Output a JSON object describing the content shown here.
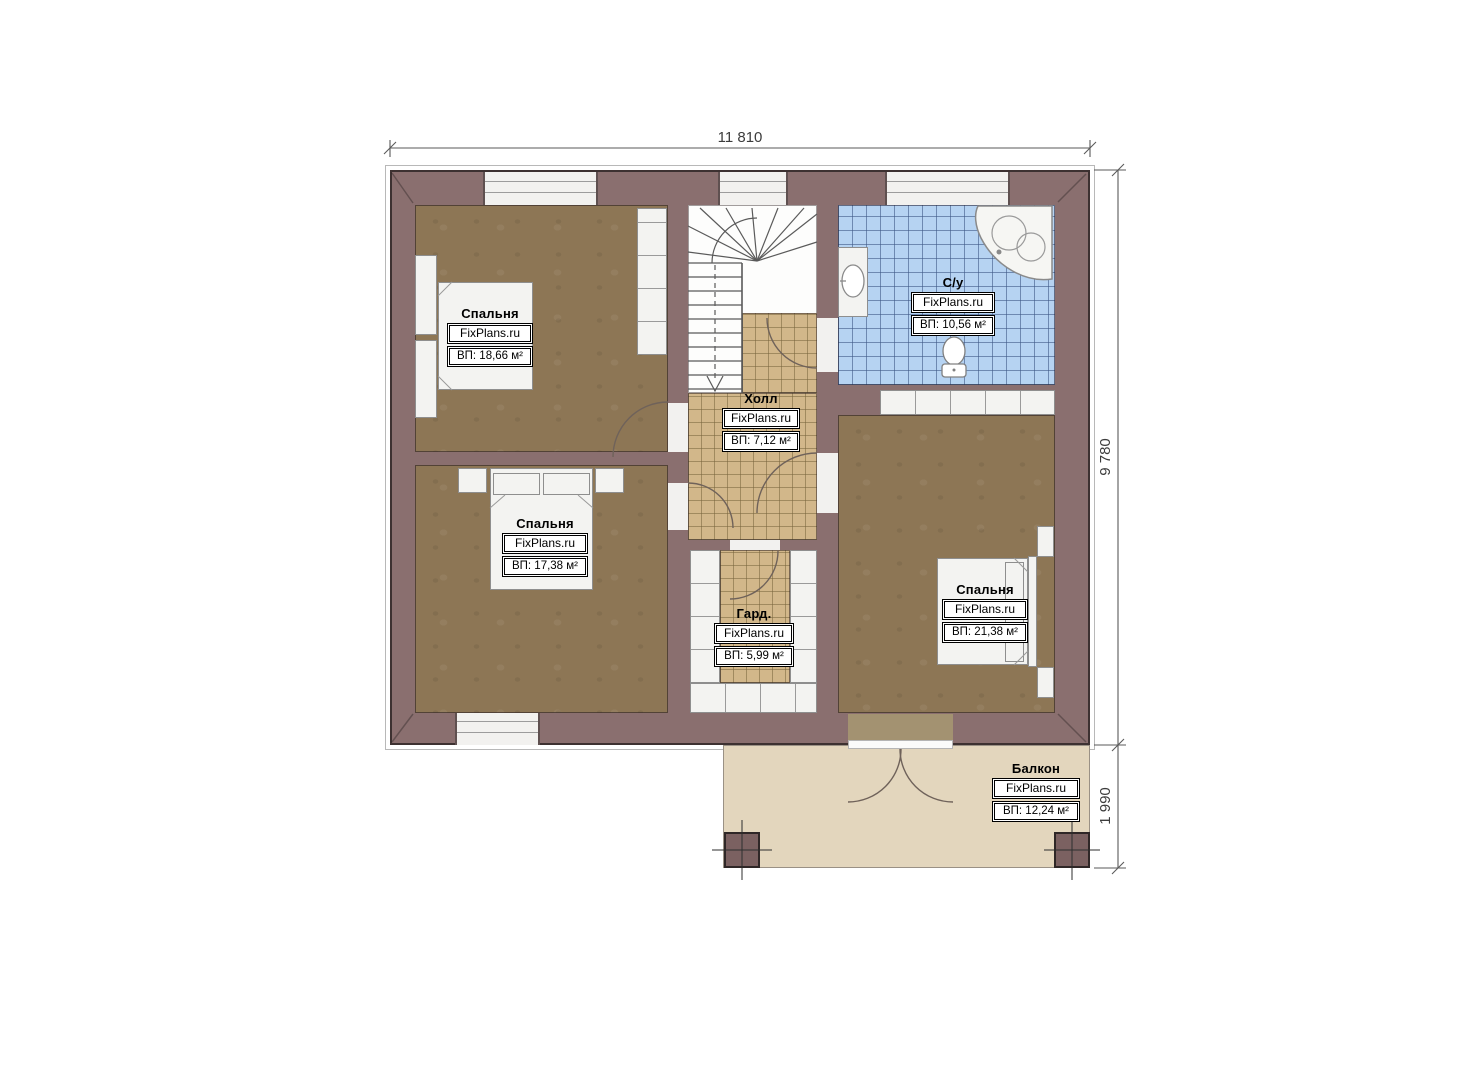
{
  "plan": {
    "source_watermark": "FixPlans.ru",
    "type_note": "second floor plan"
  },
  "watermark": {
    "text": "FixPlans.ru"
  },
  "dimensions": {
    "top": "11 810",
    "side": "9 780",
    "balcony": "1 990"
  },
  "rooms": [
    {
      "name": "Спальня",
      "area": "ВП: 18,66 м²"
    },
    {
      "name": "Спальня",
      "area": "ВП: 17,38 м²"
    },
    {
      "name": "Спальня",
      "area": "ВП: 21,38 м²"
    },
    {
      "name": "С/у",
      "area": "ВП: 10,56 м²"
    },
    {
      "name": "Холл",
      "area": "ВП: 7,12 м²"
    },
    {
      "name": "Гард.",
      "area": "ВП: 5,99 м²"
    },
    {
      "name": "Балкон",
      "area": "ВП: 12,24 м²"
    }
  ],
  "colors": {
    "wall": "#8a6f6f",
    "bedroom_floor": "#8d7655",
    "hall_tile": "#d2b78a",
    "bath_tile": "#b6d3f2",
    "balcony_floor": "#e3d6bd",
    "dimension_text": "#3c3c3c"
  }
}
